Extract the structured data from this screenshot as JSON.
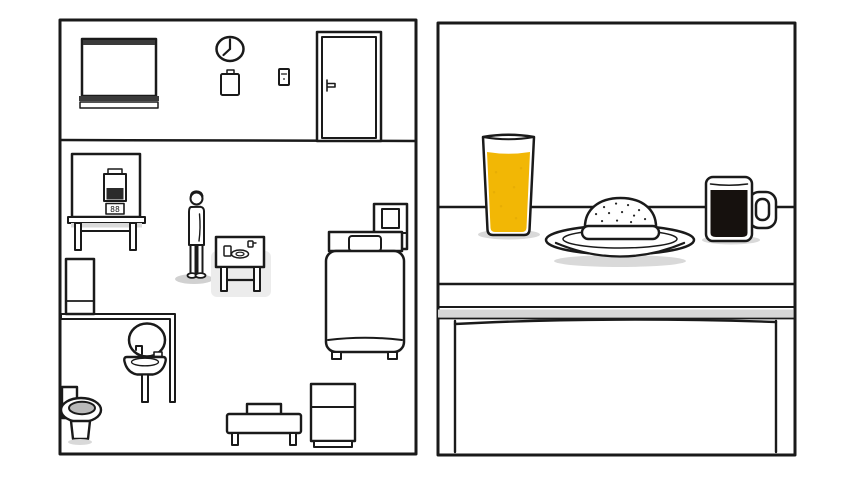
{
  "scene": {
    "game_view": "split-screen-room-and-closeup",
    "left_panel": {
      "name": "apartment-room-overview",
      "machine": {
        "display": "88"
      },
      "clock_hands": {
        "minute": "12",
        "hour": "7"
      },
      "objects": [
        "window-blind-closed",
        "wall-clock",
        "wall-notepad",
        "light-switch",
        "room-door",
        "food-machine-on-table",
        "standing-man",
        "breakfast-side-table",
        "bed-with-pillow",
        "nightstand-with-picture",
        "bathroom-cabinet",
        "bathroom-mirror",
        "bathroom-sink",
        "toilet",
        "couch",
        "storage-cabinet"
      ]
    },
    "right_panel": {
      "name": "breakfast-table-closeup",
      "items": [
        {
          "name": "orange-juice-glass",
          "state": "full"
        },
        {
          "name": "seeded-bun-on-plate",
          "state": "untouched"
        },
        {
          "name": "black-coffee-mug",
          "state": "full"
        }
      ]
    }
  },
  "colors": {
    "line": "#1a1a1a",
    "juice": "#F2B705",
    "juice_speckle": "#DFA606",
    "coffee": "#16110E",
    "shadow": "#d9d9d9",
    "soft_shadow": "#c9c9c9",
    "highlight": "#ececec",
    "table_strip": "#d6d6d6",
    "toilet_seat": "#b9b9b9",
    "carton_dark": "#2b2b2b",
    "blind_bar": "#3a3a3a",
    "seed": "#222222"
  }
}
